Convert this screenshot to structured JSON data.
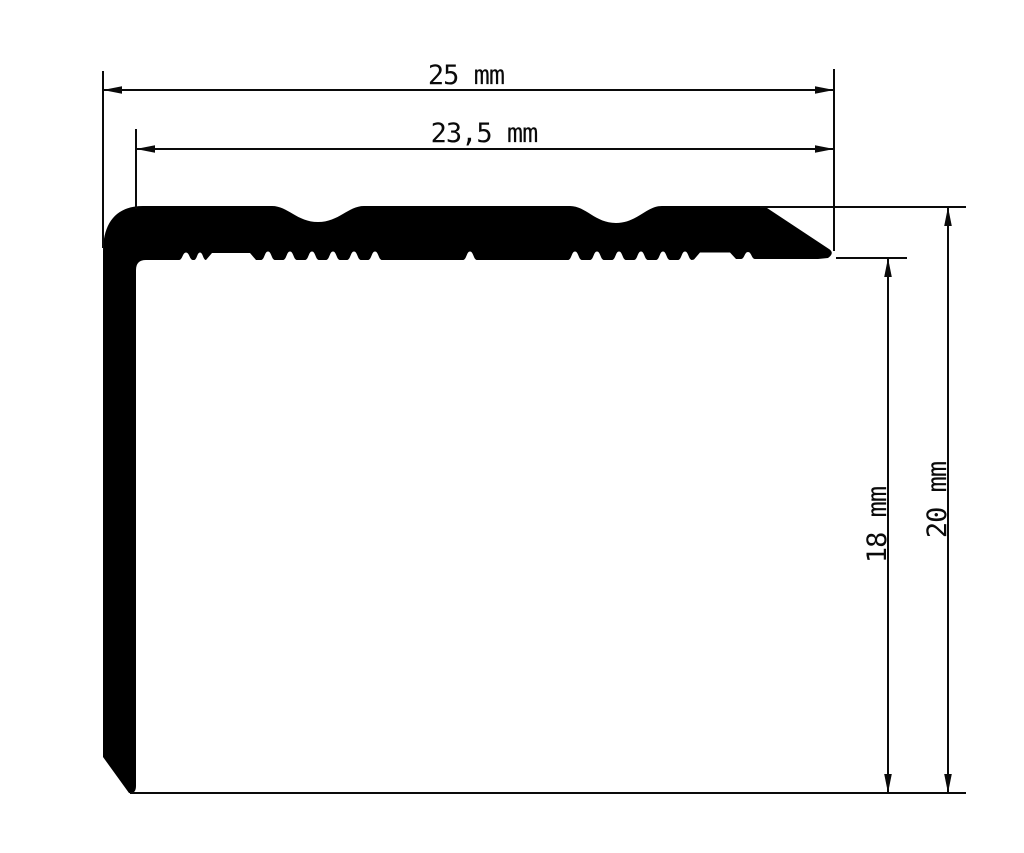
{
  "drawing": {
    "kind": "profile-cross-section-technical-drawing",
    "background_color": "#ffffff",
    "line_color": "#0a0a0a",
    "profile_fill_color": "#000000",
    "dimensions": {
      "width_outer": "25 mm",
      "width_inner": "23,5 mm",
      "height_inner": "18 mm",
      "height_outer": "20 mm"
    }
  }
}
